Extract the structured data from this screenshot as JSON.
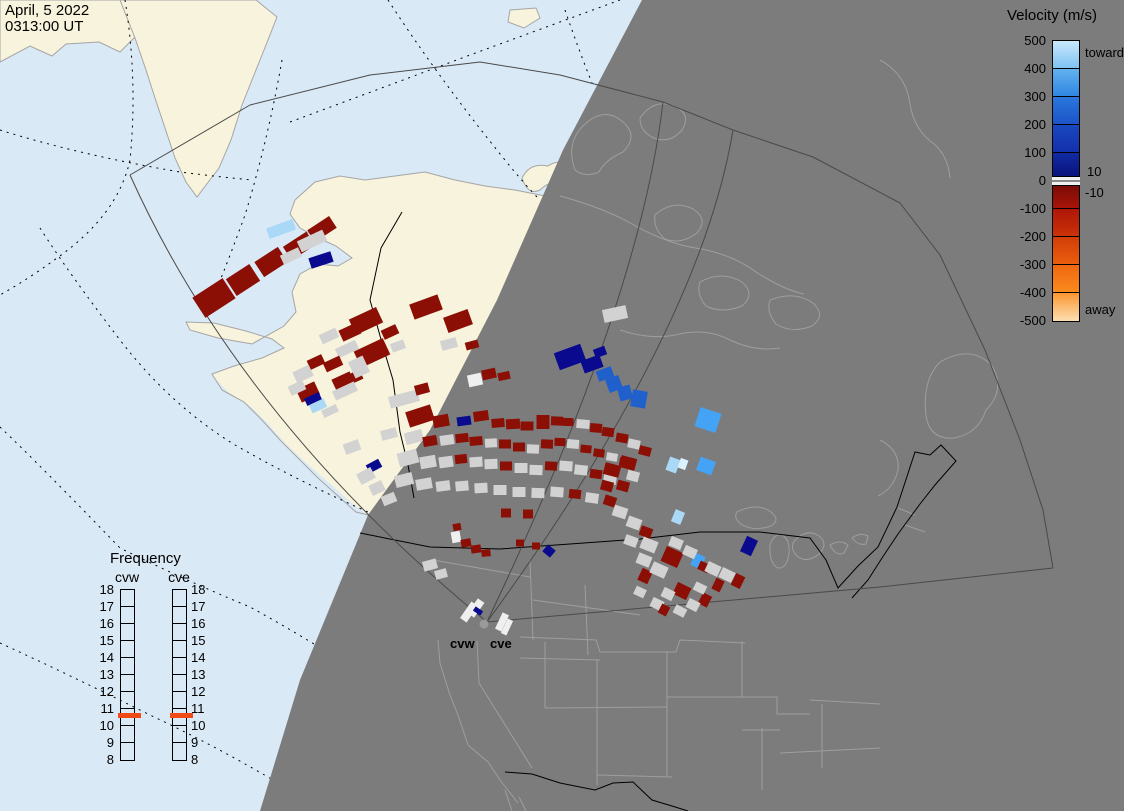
{
  "datetime": {
    "line1": "April, 5 2022",
    "line2": "0313:00 UT"
  },
  "velocity_legend": {
    "title": "Velocity (m/s)",
    "toward_label": "toward",
    "away_label": "away",
    "zero_upper_label": "10",
    "zero_lower_label": "-10",
    "ticks": [
      500,
      400,
      300,
      200,
      100,
      0,
      -100,
      -200,
      -300,
      -400,
      -500
    ],
    "range": [
      -500,
      500
    ],
    "segments": [
      {
        "v0": 500,
        "v1": 400,
        "c0": "#C9E9FC",
        "c1": "#7FC2F3"
      },
      {
        "v0": 400,
        "v1": 300,
        "c0": "#63B1EE",
        "c1": "#2F86E2"
      },
      {
        "v0": 300,
        "v1": 200,
        "c0": "#2A77DC",
        "c1": "#1C54C8"
      },
      {
        "v0": 200,
        "v1": 100,
        "c0": "#1A48BF",
        "c1": "#1230AB"
      },
      {
        "v0": 100,
        "v1": 0,
        "c0": "#112BA4",
        "c1": "#081076"
      },
      {
        "v0": 0,
        "v1": -100,
        "c0": "#700A06",
        "c1": "#A81408"
      },
      {
        "v0": -100,
        "v1": -200,
        "c0": "#AD1607",
        "c1": "#CC3208"
      },
      {
        "v0": -200,
        "v1": -300,
        "c0": "#D23D08",
        "c1": "#EA5E0E"
      },
      {
        "v0": -300,
        "v1": -400,
        "c0": "#EE670F",
        "c1": "#FA8B1E"
      },
      {
        "v0": -400,
        "v1": -500,
        "c0": "#FB9631",
        "c1": "#FDDFB2"
      }
    ],
    "zero_band": {
      "color": "#F0F0F0",
      "line_color": "#8A8A8A"
    }
  },
  "frequency_legend": {
    "title": "Frequency",
    "columns": [
      {
        "id": "cvw",
        "label": "cvw",
        "bar_left": 120,
        "label_left": 107,
        "marker_left": 118,
        "ticks_side": "left"
      },
      {
        "id": "cve",
        "label": "cve",
        "bar_left": 172,
        "label_left": 159,
        "marker_left": 170,
        "ticks_side": "right"
      }
    ],
    "ticks": [
      18,
      17,
      16,
      15,
      14,
      13,
      12,
      11,
      10,
      9,
      8
    ],
    "range": [
      8,
      18
    ],
    "marker_value": 10.6,
    "marker_color": "#F04A15"
  },
  "radar_site": {
    "labels": [
      "cvw",
      "cve"
    ]
  },
  "map": {
    "colors": {
      "ocean": "#DAE9F6",
      "land": "#F8F3DC",
      "coast": "#A5A5A5",
      "night": "#7C7C7C",
      "night_lines": "#9E9E9E",
      "borders": "#000000",
      "fan_lines": "#4A4A4A",
      "radar_dot": "#9A9A9A"
    },
    "palette": {
      "r": "#8B0F05",
      "g": "#D2D2D2",
      "n": "#0A0A8F",
      "b": "#2060CC",
      "B": "#45A3F5",
      "p": "#A9D9F7",
      "P": "#DCF0FD",
      "w": "#EFEFEF"
    },
    "cells": [
      [
        214,
        298,
        36,
        24,
        -33,
        "r"
      ],
      [
        243,
        280,
        28,
        20,
        -33,
        "r"
      ],
      [
        271,
        262,
        28,
        18,
        -33,
        "r"
      ],
      [
        299,
        246,
        28,
        16,
        -33,
        "r"
      ],
      [
        322,
        229,
        26,
        14,
        -33,
        "r"
      ],
      [
        281,
        229,
        28,
        11,
        -20,
        "p"
      ],
      [
        312,
        241,
        28,
        12,
        -25,
        "g"
      ],
      [
        291,
        256,
        20,
        10,
        -25,
        "g"
      ],
      [
        321,
        260,
        23,
        11,
        -18,
        "n"
      ],
      [
        366,
        321,
        30,
        17,
        -25,
        "r"
      ],
      [
        350,
        332,
        20,
        12,
        -25,
        "r"
      ],
      [
        426,
        307,
        30,
        16,
        -20,
        "r"
      ],
      [
        458,
        321,
        26,
        16,
        -20,
        "r"
      ],
      [
        390,
        332,
        16,
        10,
        -25,
        "r"
      ],
      [
        329,
        336,
        18,
        10,
        -25,
        "g"
      ],
      [
        347,
        349,
        22,
        10,
        -25,
        "g"
      ],
      [
        372,
        353,
        32,
        18,
        -25,
        "r"
      ],
      [
        398,
        346,
        14,
        9,
        -20,
        "g"
      ],
      [
        316,
        362,
        16,
        10,
        -25,
        "r"
      ],
      [
        333,
        364,
        18,
        10,
        -25,
        "r"
      ],
      [
        303,
        374,
        18,
        12,
        -25,
        "g"
      ],
      [
        343,
        381,
        20,
        12,
        -25,
        "r"
      ],
      [
        355,
        377,
        14,
        10,
        -25,
        "r"
      ],
      [
        359,
        367,
        16,
        18,
        -25,
        "g"
      ],
      [
        308,
        392,
        20,
        14,
        -25,
        "r"
      ],
      [
        345,
        391,
        24,
        10,
        -25,
        "g"
      ],
      [
        297,
        388,
        16,
        10,
        -25,
        "g"
      ],
      [
        313,
        399,
        16,
        8,
        -25,
        "n"
      ],
      [
        318,
        406,
        16,
        9,
        -25,
        "p"
      ],
      [
        330,
        411,
        16,
        8,
        -25,
        "g"
      ],
      [
        404,
        399,
        30,
        12,
        -15,
        "g"
      ],
      [
        422,
        389,
        14,
        10,
        -15,
        "r"
      ],
      [
        389,
        434,
        16,
        10,
        -15,
        "g"
      ],
      [
        416,
        420,
        13,
        10,
        -15,
        "r"
      ],
      [
        449,
        344,
        16,
        10,
        -15,
        "g"
      ],
      [
        472,
        345,
        13,
        8,
        -15,
        "r"
      ],
      [
        489,
        374,
        14,
        10,
        -12,
        "r"
      ],
      [
        504,
        376,
        12,
        8,
        -12,
        "r"
      ],
      [
        475,
        380,
        14,
        12,
        -12,
        "w"
      ],
      [
        615,
        314,
        24,
        13,
        -12,
        "g"
      ],
      [
        420,
        416,
        26,
        16,
        -18,
        "r"
      ],
      [
        441,
        421,
        16,
        12,
        -10,
        "r"
      ],
      [
        464,
        421,
        14,
        9,
        -8,
        "n"
      ],
      [
        481,
        416,
        15,
        10,
        -8,
        "r"
      ],
      [
        498,
        423,
        13,
        9,
        -5,
        "r"
      ],
      [
        513,
        424,
        14,
        10,
        -3,
        "r"
      ],
      [
        527,
        426,
        13,
        9,
        0,
        "r"
      ],
      [
        543,
        422,
        13,
        14,
        0,
        "r"
      ],
      [
        557,
        421,
        12,
        9,
        2,
        "r"
      ],
      [
        568,
        422,
        11,
        8,
        2,
        "r"
      ],
      [
        583,
        424,
        13,
        9,
        5,
        "g"
      ],
      [
        596,
        428,
        12,
        9,
        5,
        "r"
      ],
      [
        608,
        432,
        12,
        9,
        8,
        "r"
      ],
      [
        622,
        438,
        12,
        9,
        10,
        "r"
      ],
      [
        634,
        444,
        12,
        9,
        12,
        "g"
      ],
      [
        645,
        451,
        12,
        9,
        14,
        "r"
      ],
      [
        414,
        437,
        18,
        12,
        -15,
        "g"
      ],
      [
        430,
        441,
        14,
        10,
        -10,
        "r"
      ],
      [
        447,
        440,
        14,
        10,
        -8,
        "g"
      ],
      [
        462,
        438,
        13,
        9,
        -6,
        "r"
      ],
      [
        476,
        441,
        13,
        9,
        -5,
        "r"
      ],
      [
        491,
        443,
        12,
        9,
        -3,
        "g"
      ],
      [
        505,
        444,
        12,
        9,
        0,
        "r"
      ],
      [
        519,
        447,
        12,
        9,
        0,
        "r"
      ],
      [
        533,
        449,
        12,
        9,
        2,
        "g"
      ],
      [
        547,
        444,
        12,
        9,
        2,
        "r"
      ],
      [
        560,
        442,
        11,
        8,
        3,
        "r"
      ],
      [
        573,
        444,
        12,
        9,
        5,
        "g"
      ],
      [
        586,
        449,
        11,
        8,
        6,
        "r"
      ],
      [
        599,
        453,
        11,
        8,
        8,
        "r"
      ],
      [
        612,
        457,
        11,
        8,
        10,
        "g"
      ],
      [
        625,
        462,
        11,
        8,
        12,
        "r"
      ],
      [
        408,
        458,
        20,
        14,
        -15,
        "g"
      ],
      [
        428,
        462,
        16,
        12,
        -10,
        "g"
      ],
      [
        446,
        462,
        14,
        11,
        -8,
        "g"
      ],
      [
        461,
        459,
        12,
        9,
        -6,
        "r"
      ],
      [
        476,
        462,
        13,
        10,
        -4,
        "g"
      ],
      [
        491,
        464,
        13,
        10,
        -2,
        "g"
      ],
      [
        506,
        466,
        12,
        9,
        0,
        "r"
      ],
      [
        521,
        468,
        13,
        10,
        0,
        "g"
      ],
      [
        536,
        470,
        13,
        10,
        2,
        "g"
      ],
      [
        551,
        466,
        12,
        9,
        3,
        "r"
      ],
      [
        566,
        466,
        13,
        10,
        4,
        "g"
      ],
      [
        581,
        470,
        13,
        10,
        6,
        "g"
      ],
      [
        596,
        474,
        12,
        9,
        8,
        "r"
      ],
      [
        610,
        479,
        13,
        10,
        10,
        "g"
      ],
      [
        404,
        480,
        18,
        12,
        -14,
        "g"
      ],
      [
        424,
        484,
        16,
        11,
        -10,
        "g"
      ],
      [
        443,
        486,
        14,
        10,
        -7,
        "g"
      ],
      [
        462,
        486,
        13,
        10,
        -5,
        "g"
      ],
      [
        481,
        488,
        13,
        10,
        -3,
        "g"
      ],
      [
        500,
        490,
        13,
        10,
        0,
        "g"
      ],
      [
        519,
        492,
        13,
        10,
        0,
        "g"
      ],
      [
        538,
        493,
        13,
        10,
        2,
        "g"
      ],
      [
        557,
        492,
        13,
        10,
        4,
        "g"
      ],
      [
        575,
        494,
        12,
        9,
        6,
        "r"
      ],
      [
        592,
        498,
        13,
        10,
        8,
        "g"
      ],
      [
        374,
        466,
        14,
        9,
        -28,
        "n"
      ],
      [
        366,
        476,
        16,
        12,
        -28,
        "g"
      ],
      [
        377,
        488,
        14,
        11,
        -25,
        "g"
      ],
      [
        389,
        499,
        14,
        10,
        -22,
        "g"
      ],
      [
        352,
        447,
        16,
        11,
        -20,
        "g"
      ],
      [
        506,
        513,
        10,
        9,
        0,
        "r"
      ],
      [
        528,
        514,
        10,
        9,
        0,
        "r"
      ],
      [
        520,
        543,
        8,
        7,
        0,
        "r"
      ],
      [
        536,
        546,
        8,
        7,
        0,
        "r"
      ],
      [
        456,
        537,
        9,
        11,
        -10,
        "w"
      ],
      [
        466,
        543,
        10,
        8,
        -10,
        "r"
      ],
      [
        476,
        549,
        10,
        8,
        -8,
        "r"
      ],
      [
        486,
        553,
        9,
        7,
        -5,
        "r"
      ],
      [
        457,
        527,
        8,
        7,
        -10,
        "r"
      ],
      [
        549,
        551,
        10,
        9,
        40,
        "n"
      ],
      [
        430,
        565,
        14,
        10,
        -15,
        "g"
      ],
      [
        441,
        574,
        12,
        9,
        -15,
        "g"
      ],
      [
        570,
        357,
        28,
        18,
        -20,
        "n"
      ],
      [
        592,
        364,
        20,
        13,
        -20,
        "n"
      ],
      [
        605,
        374,
        16,
        11,
        -20,
        "b"
      ],
      [
        614,
        384,
        14,
        14,
        -20,
        "b"
      ],
      [
        600,
        352,
        12,
        9,
        -20,
        "n"
      ],
      [
        625,
        393,
        13,
        14,
        -15,
        "b"
      ],
      [
        639,
        399,
        15,
        17,
        10,
        "b"
      ],
      [
        708,
        420,
        22,
        20,
        18,
        "B"
      ],
      [
        673,
        465,
        11,
        14,
        20,
        "p"
      ],
      [
        683,
        464,
        8,
        10,
        20,
        "P"
      ],
      [
        706,
        466,
        16,
        14,
        20,
        "B"
      ],
      [
        678,
        517,
        10,
        13,
        22,
        "p"
      ],
      [
        698,
        561,
        11,
        13,
        25,
        "B"
      ],
      [
        749,
        546,
        12,
        17,
        25,
        "n"
      ],
      [
        612,
        470,
        16,
        12,
        15,
        "r"
      ],
      [
        628,
        463,
        16,
        12,
        15,
        "r"
      ],
      [
        607,
        486,
        12,
        10,
        15,
        "r"
      ],
      [
        623,
        486,
        12,
        10,
        15,
        "r"
      ],
      [
        610,
        501,
        12,
        10,
        18,
        "r"
      ],
      [
        633,
        476,
        12,
        10,
        15,
        "g"
      ],
      [
        620,
        512,
        14,
        11,
        18,
        "g"
      ],
      [
        634,
        523,
        14,
        11,
        20,
        "g"
      ],
      [
        646,
        532,
        12,
        10,
        20,
        "r"
      ],
      [
        649,
        545,
        16,
        12,
        22,
        "g"
      ],
      [
        631,
        541,
        13,
        10,
        20,
        "g"
      ],
      [
        645,
        576,
        11,
        13,
        25,
        "r"
      ],
      [
        644,
        560,
        14,
        11,
        22,
        "g"
      ],
      [
        659,
        570,
        16,
        12,
        24,
        "g"
      ],
      [
        672,
        557,
        18,
        16,
        24,
        "r"
      ],
      [
        676,
        543,
        13,
        10,
        22,
        "g"
      ],
      [
        690,
        552,
        13,
        10,
        24,
        "g"
      ],
      [
        704,
        567,
        11,
        9,
        25,
        "r"
      ],
      [
        713,
        569,
        14,
        11,
        25,
        "g"
      ],
      [
        727,
        575,
        14,
        11,
        26,
        "g"
      ],
      [
        738,
        581,
        10,
        13,
        26,
        "r"
      ],
      [
        718,
        585,
        9,
        12,
        26,
        "r"
      ],
      [
        682,
        591,
        15,
        13,
        26,
        "r"
      ],
      [
        705,
        600,
        10,
        12,
        27,
        "r"
      ],
      [
        693,
        605,
        12,
        10,
        27,
        "g"
      ],
      [
        668,
        594,
        12,
        10,
        26,
        "g"
      ],
      [
        657,
        604,
        12,
        10,
        26,
        "g"
      ],
      [
        680,
        611,
        12,
        9,
        27,
        "g"
      ],
      [
        664,
        610,
        9,
        10,
        27,
        "r"
      ],
      [
        700,
        588,
        12,
        9,
        26,
        "g"
      ],
      [
        640,
        592,
        11,
        9,
        25,
        "g"
      ],
      [
        469,
        612,
        20,
        8,
        -55,
        "w"
      ],
      [
        476,
        608,
        18,
        8,
        -55,
        "w"
      ],
      [
        478,
        611,
        5,
        9,
        -55,
        "n"
      ],
      [
        502,
        622,
        18,
        7,
        -65,
        "w"
      ],
      [
        507,
        627,
        16,
        6,
        -65,
        "w"
      ]
    ]
  }
}
